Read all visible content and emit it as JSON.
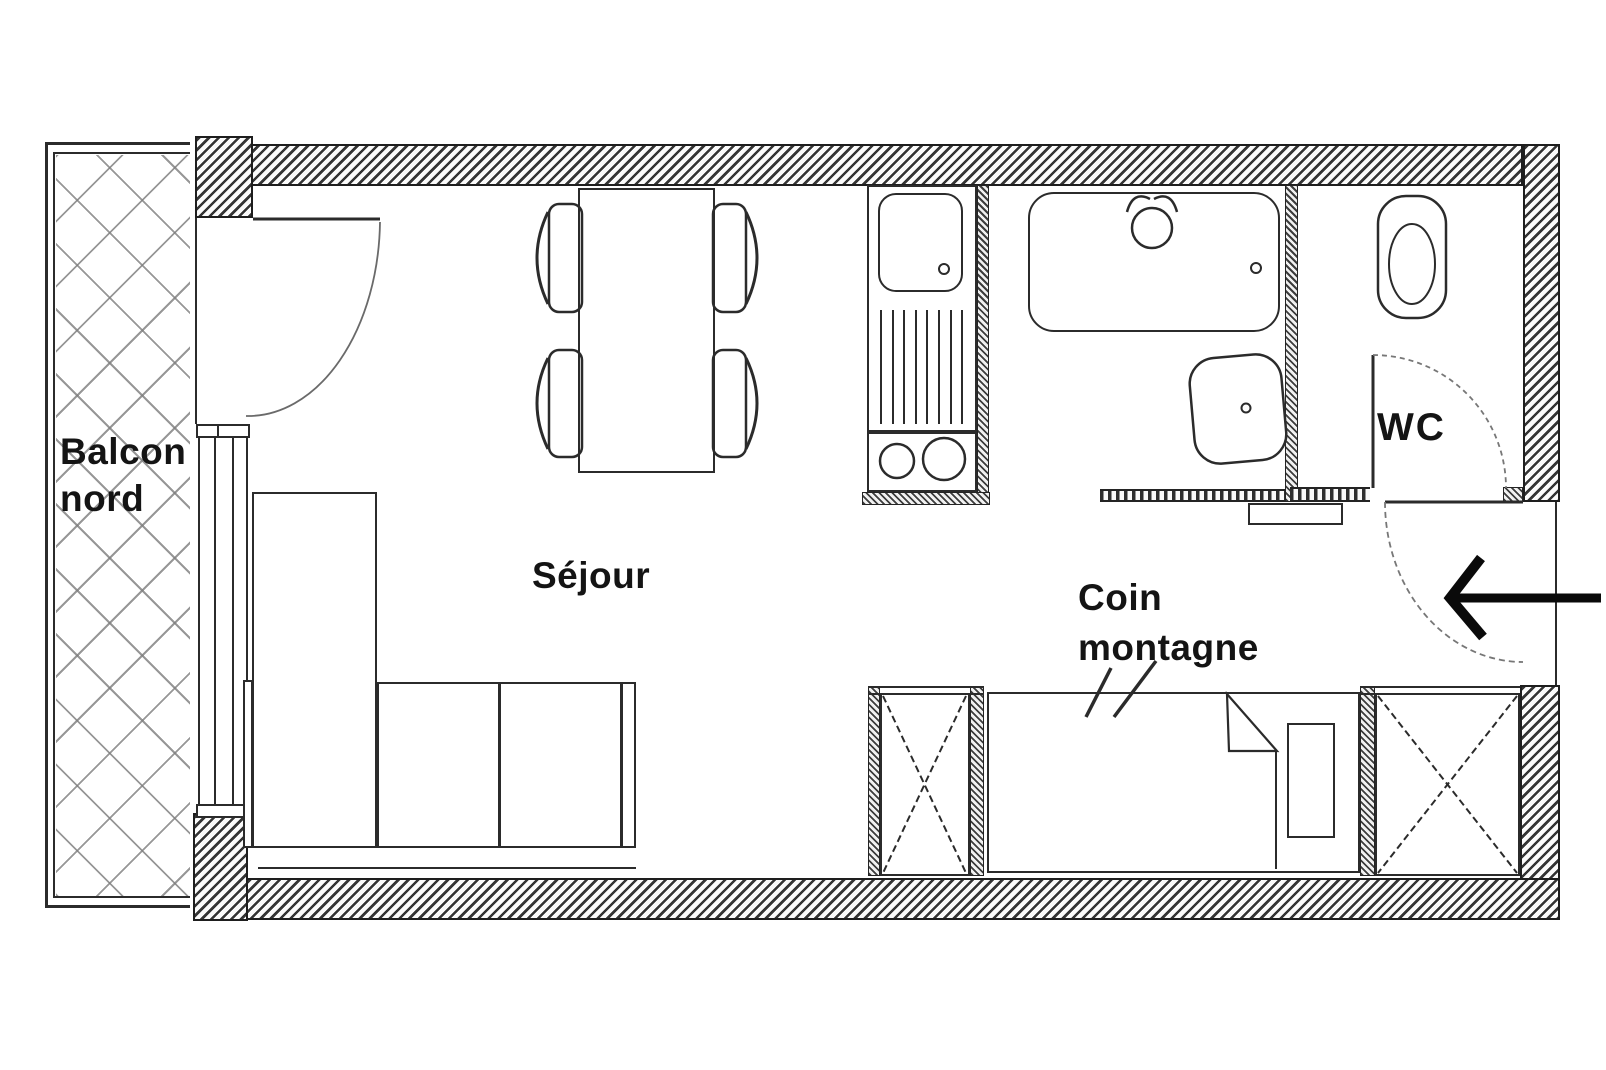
{
  "title": "Studio apartment floor plan",
  "labels": {
    "balcony": {
      "line1": "Balcon",
      "line2": "nord"
    },
    "living_room": "Séjour",
    "sleeping_nook": {
      "line1": "Coin",
      "line2": "montagne"
    },
    "toilet_room": "WC"
  },
  "icons": {
    "entrance_arrow": "left-arrow"
  },
  "colors": {
    "wall_hatch": "#343434",
    "outline": "#2b2b2b",
    "balcony_lattice": "#7d7d7d",
    "text": "#141414",
    "arrow": "#0a0a0a",
    "background": "#ffffff"
  }
}
